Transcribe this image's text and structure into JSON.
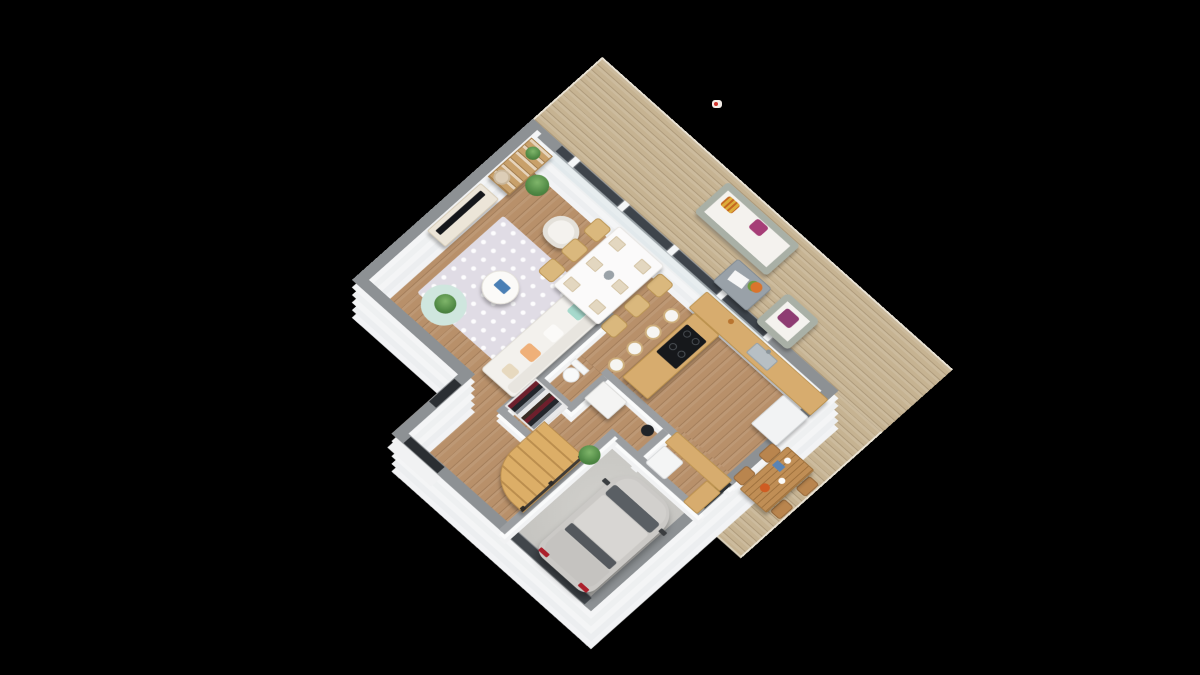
{
  "scene": {
    "type": "3d-floor-plan-render",
    "description": "Isometric 3D render of a house ground floor on a black background",
    "background_color": "#000000",
    "rooms": [
      {
        "id": "terrace-deck",
        "label": "terrace deck"
      },
      {
        "id": "living-room",
        "label": "living room"
      },
      {
        "id": "dining-area",
        "label": "dining area"
      },
      {
        "id": "kitchen",
        "label": "kitchen"
      },
      {
        "id": "hallway",
        "label": "hallway"
      },
      {
        "id": "wc",
        "label": "wc"
      },
      {
        "id": "closet",
        "label": "closet"
      },
      {
        "id": "staircase",
        "label": "staircase"
      },
      {
        "id": "entry",
        "label": "entry"
      },
      {
        "id": "laundry-room",
        "label": "laundry room"
      },
      {
        "id": "garage",
        "label": "garage"
      }
    ],
    "furniture": [
      "bookshelf",
      "tv-stand",
      "tv",
      "floor-lamp",
      "potted-plants",
      "area-rug",
      "round-rug",
      "coffee-table",
      "tub-armchair",
      "three-seat-sofa",
      "dining-table-6-chairs",
      "kitchen-counter",
      "sink",
      "induction-hob",
      "bar-stools",
      "fridge",
      "laundry-counter",
      "washer",
      "toilet",
      "wardrobe-clothes",
      "winder-stairs",
      "silver-car",
      "outdoor-sofa",
      "wicker-coffee-table",
      "wicker-armchair",
      "outdoor-dining-table-4-chairs"
    ],
    "palette": {
      "deck_wood": "#c6b392",
      "interior_wood": "#b8906a",
      "wall_cap_exterior": "#8d9194",
      "wall_cap_interior": "#9b9ea1",
      "wall_face": "#f4f5f6",
      "glass_frame": "#3e444b",
      "garage_floor": "#cbcac6",
      "car_body": "#cbc9c6",
      "car_glass": "#5a5f64",
      "taillight_red": "#ab1f2b",
      "sofa_white": "#f3f1ed",
      "rug_lavender": "#e0dce5",
      "rug_teal": "#cfe6de",
      "pillow_teal": "#a6d9cc",
      "pillow_orange": "#efb079",
      "pillow_magenta": "#a63e77",
      "pillow_yellow": "#ddac3b",
      "pillow_purple": "#8e3c72",
      "stairs_wood": "#dcae67",
      "kitchen_wood": "#d7ac6e",
      "outdoor_frame": "#a9b0a6",
      "hob_black": "#16181b",
      "artifact_dot_red": "#d0342c"
    }
  }
}
